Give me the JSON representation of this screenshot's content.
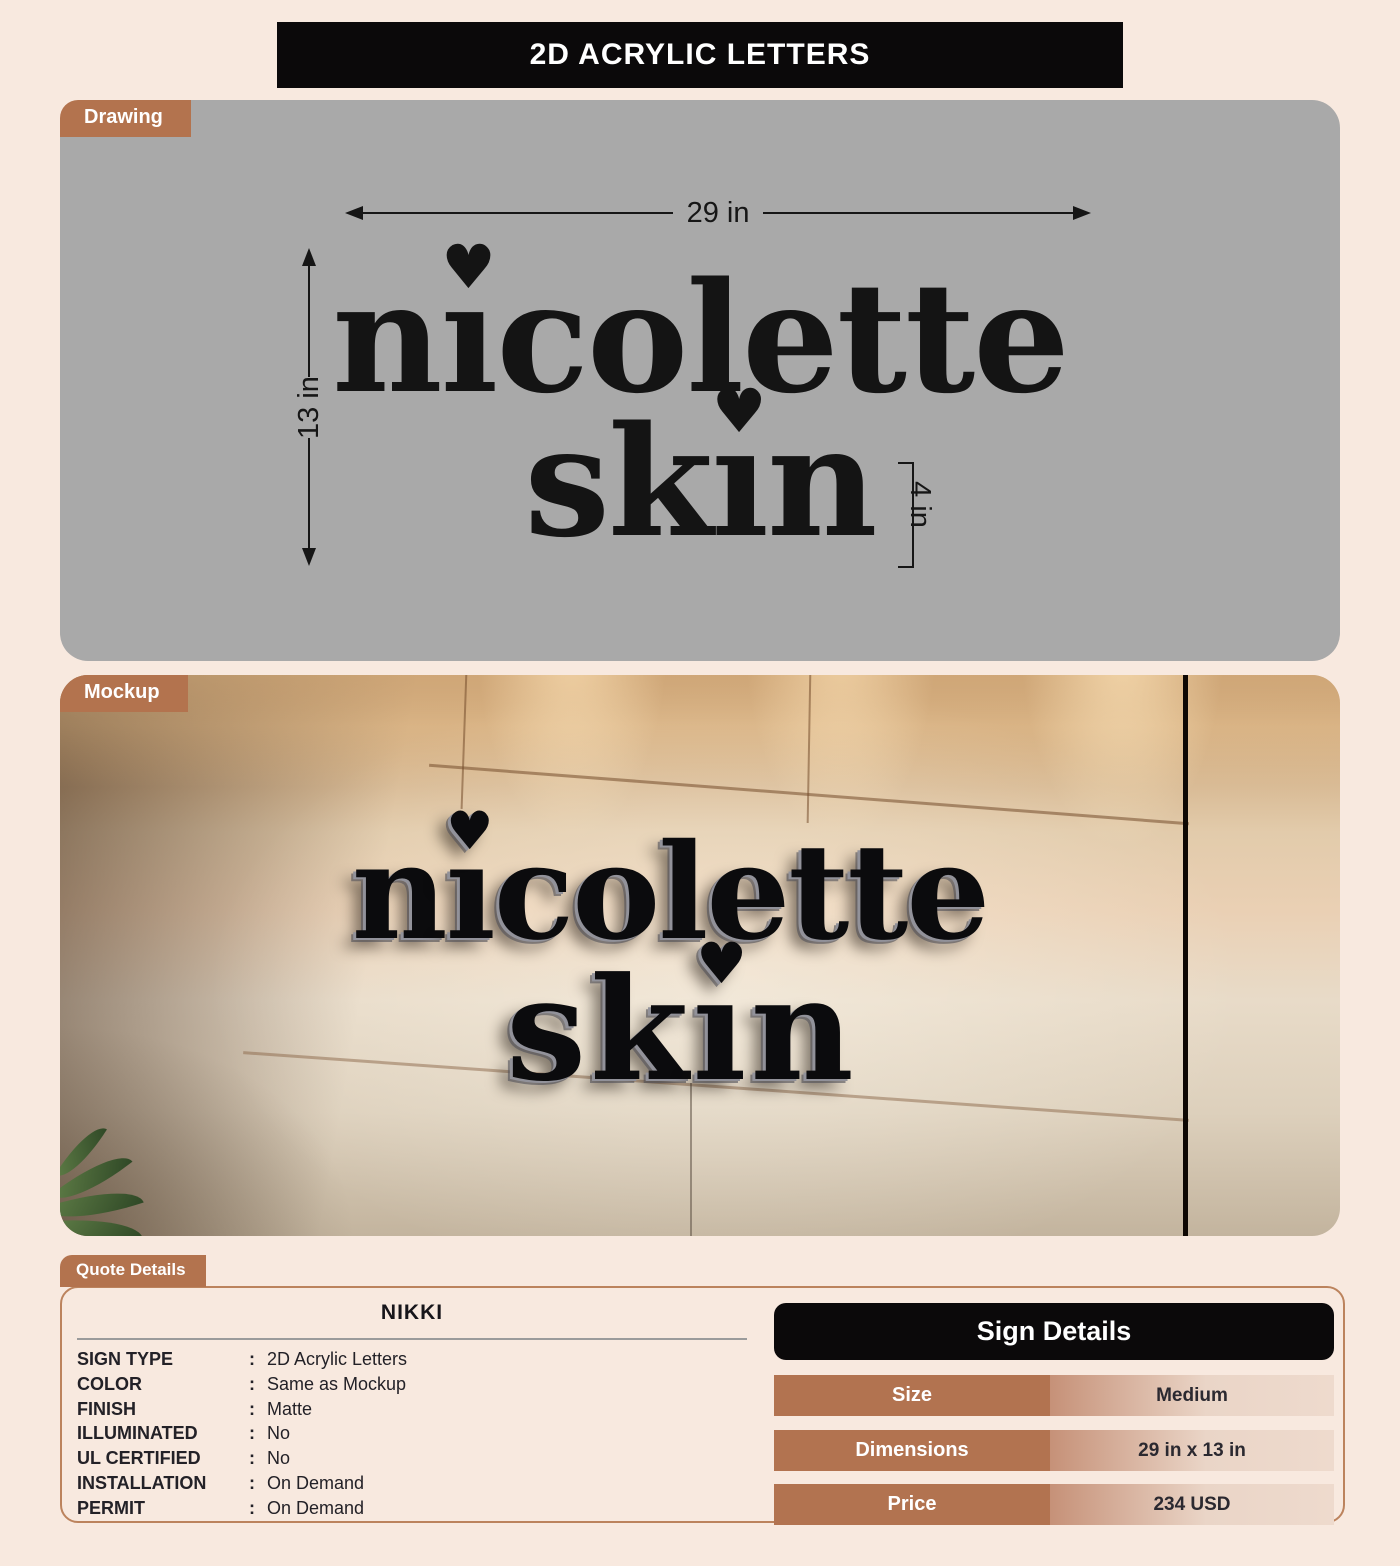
{
  "page": {
    "title": "2D ACRYLIC LETTERS",
    "accent_color": "#b3734e",
    "background_color": "#f8e9df"
  },
  "logo": {
    "line1_pre": "n",
    "line1_post": "colette",
    "line2_pre": "sk",
    "line2_post": "n",
    "dotless_i": "ı",
    "heart": "♥"
  },
  "drawing": {
    "tab_label": "Drawing",
    "width_label": "29 in",
    "height_label": "13 in",
    "letter_height_label": "4 in"
  },
  "mockup": {
    "tab_label": "Mockup"
  },
  "quote": {
    "tab_label": "Quote Details",
    "name": "NIKKI",
    "fields": [
      {
        "label": "SIGN TYPE",
        "colon": ":",
        "value": "2D Acrylic Letters"
      },
      {
        "label": "COLOR",
        "colon": ":",
        "value": "Same as Mockup"
      },
      {
        "label": "FINISH",
        "colon": ":",
        "value": "Matte"
      },
      {
        "label": "ILLUMINATED",
        "colon": ":",
        "value": "No"
      },
      {
        "label": "UL CERTIFIED",
        "colon": ":",
        "value": "No"
      },
      {
        "label": "INSTALLATION",
        "colon": ":",
        "value": "On Demand"
      },
      {
        "label": "PERMIT",
        "colon": ":",
        "value": "On Demand"
      }
    ]
  },
  "sign_details": {
    "title": "Sign Details",
    "rows": [
      {
        "label": "Size",
        "value": "Medium"
      },
      {
        "label": "Dimensions",
        "value": "29 in x 13 in"
      },
      {
        "label": "Price",
        "value": "234 USD"
      }
    ]
  }
}
